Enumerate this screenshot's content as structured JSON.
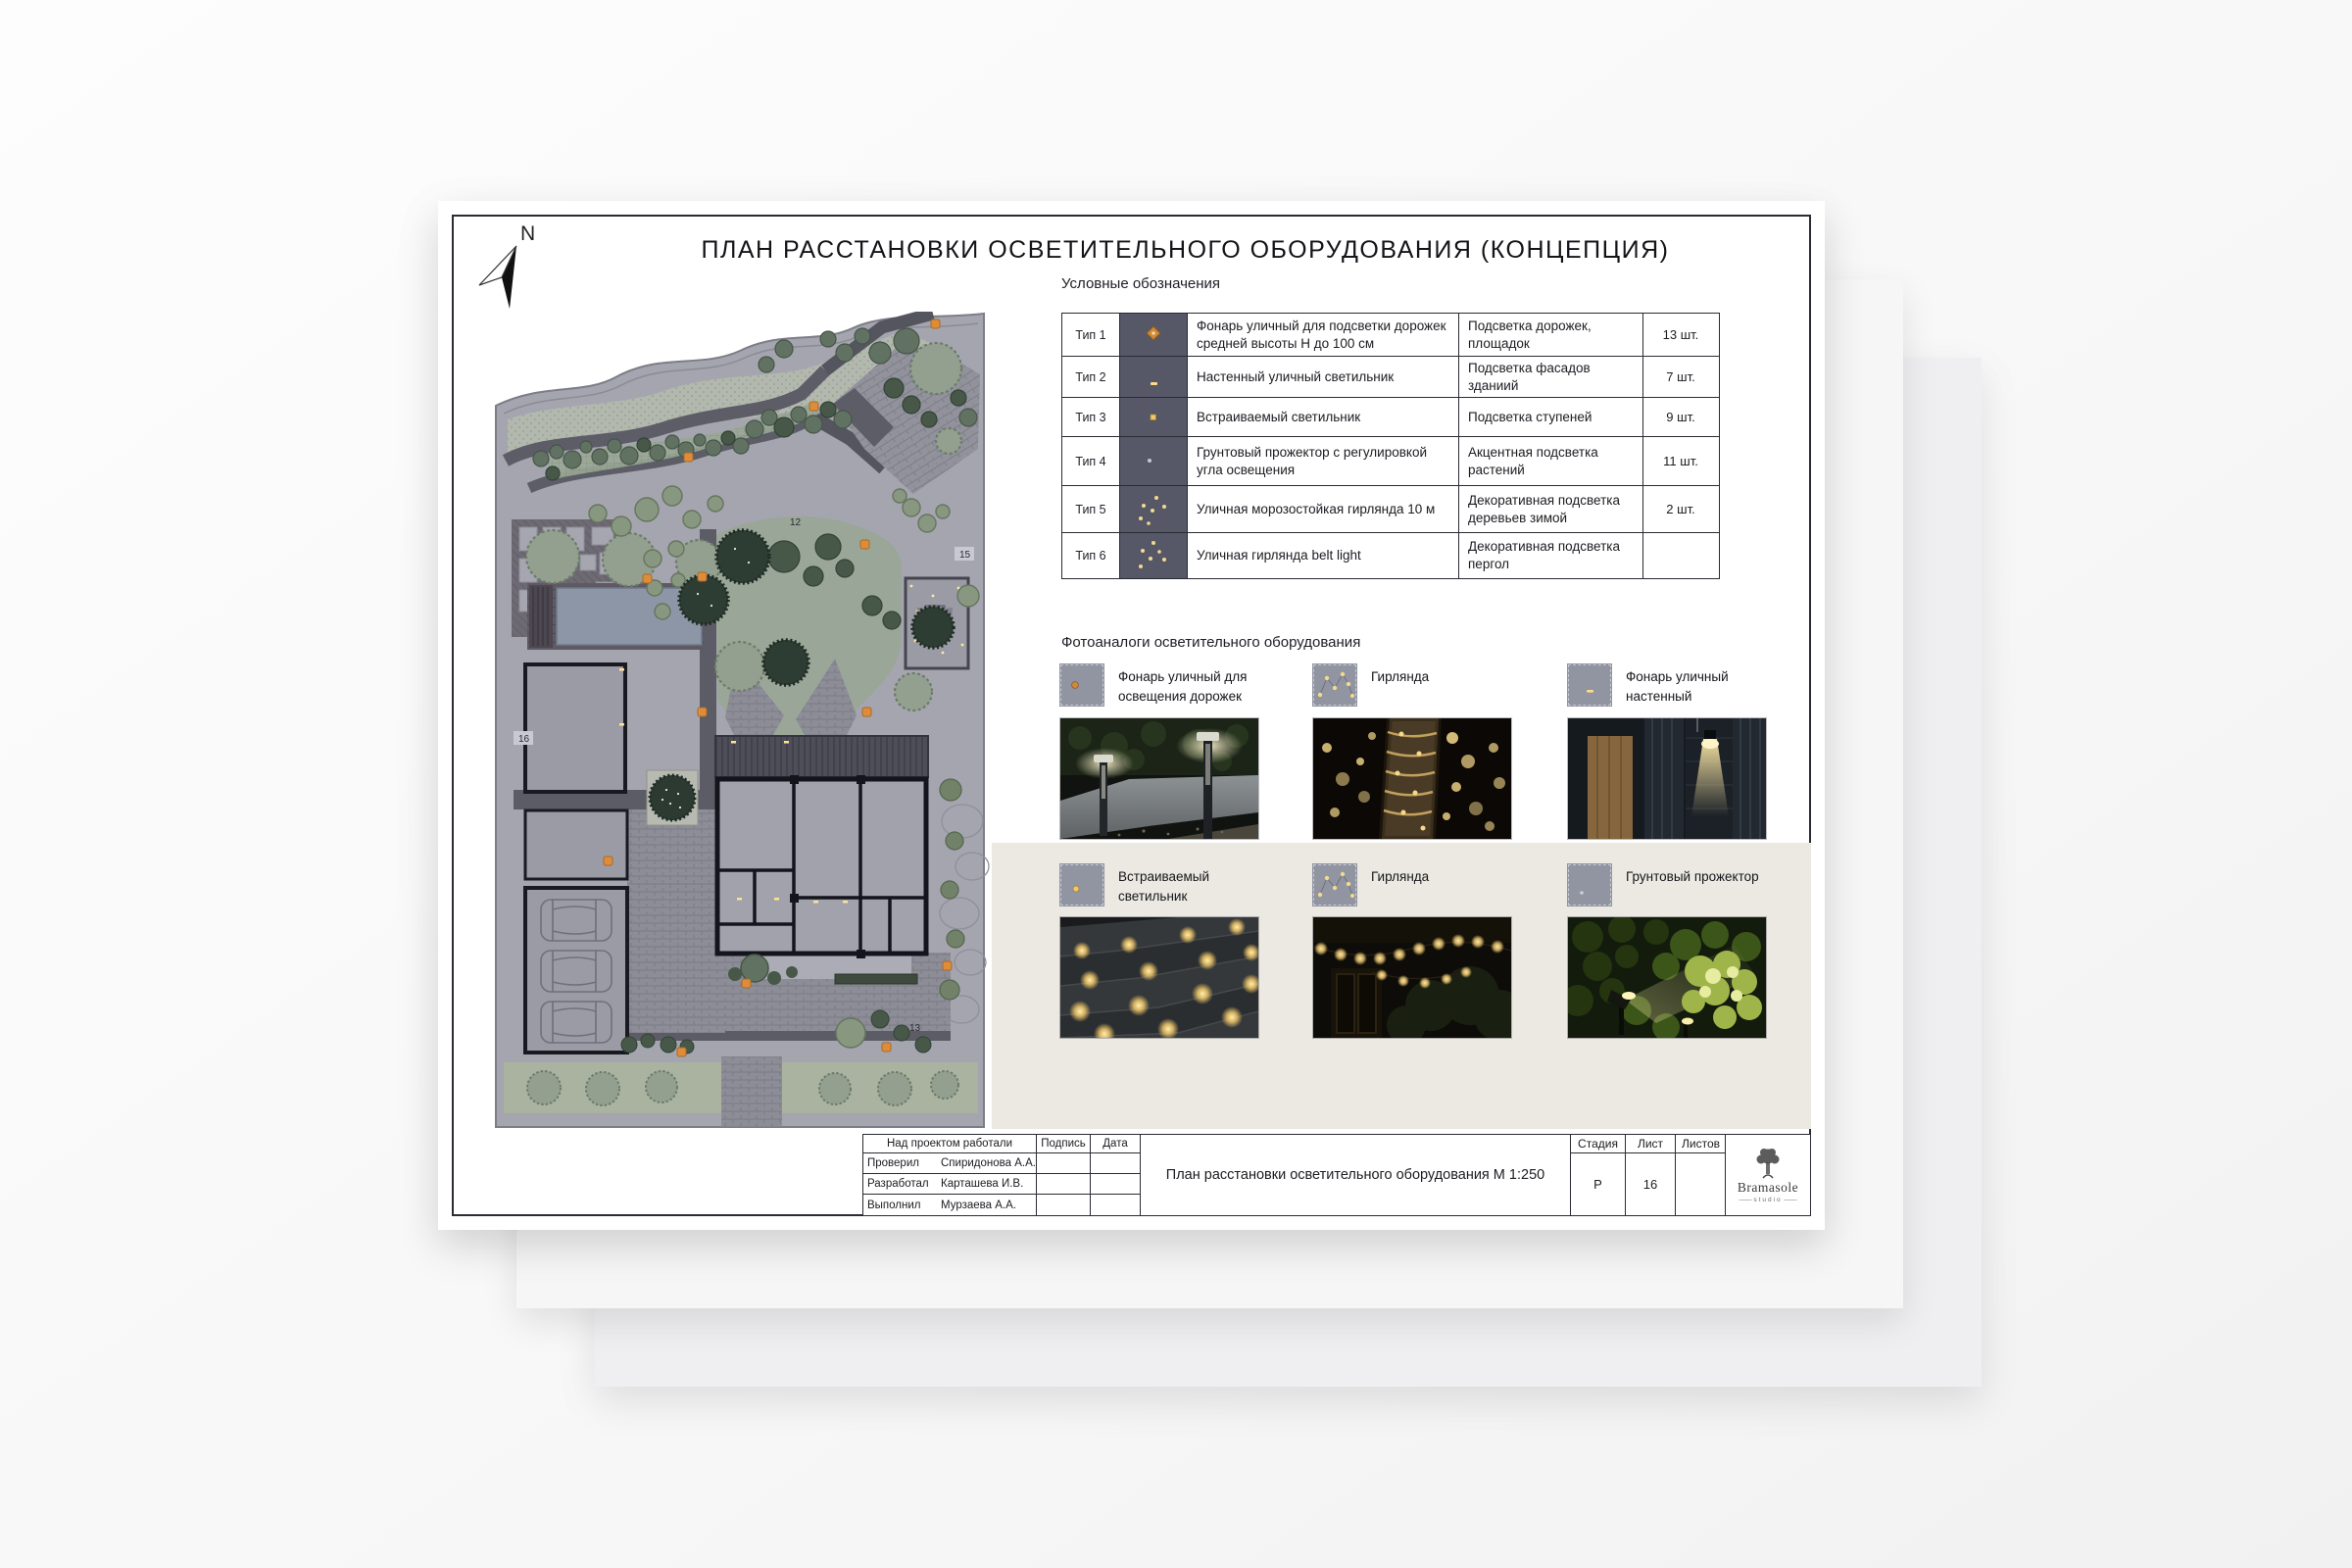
{
  "sheet": {
    "title": "ПЛАН РАССТАНОВКИ ОСВЕТИТЕЛЬНОГО ОБОРУДОВАНИЯ (КОНЦЕПЦИЯ)"
  },
  "north": {
    "label": "N"
  },
  "legend": {
    "title": "Условные обозначения",
    "rows": [
      {
        "type": "Тип 1",
        "icon": "bollard-light",
        "description": "Фонарь уличный для подсветки дорожек средней высоты Н до 100 см",
        "purpose": "Подсветка дорожек, площадок",
        "count": "13 шт."
      },
      {
        "type": "Тип 2",
        "icon": "wall-light",
        "description": "Настенный уличный светильник",
        "purpose": "Подсветка фасадов зданиий",
        "count": "7 шт."
      },
      {
        "type": "Тип 3",
        "icon": "recessed-light",
        "description": "Встраиваемый светильник",
        "purpose": "Подсветка ступеней",
        "count": "9 шт."
      },
      {
        "type": "Тип 4",
        "icon": "ground-spotlight",
        "description": "Грунтовый прожектор с регулировкой угла освещения",
        "purpose": "Акцентная подсветка растений",
        "count": "11 шт."
      },
      {
        "type": "Тип 5",
        "icon": "garland",
        "description": "Уличная морозостойкая гирлянда 10 м",
        "purpose": "Декоративная подсветка деревьев зимой",
        "count": "2 шт."
      },
      {
        "type": "Тип 6",
        "icon": "belt-light-garland",
        "description": "Уличная гирлянда belt light",
        "purpose": "Декоративная подсветка пергол",
        "count": ""
      }
    ]
  },
  "photos": {
    "title": "Фотоаналоги осветительного оборудования",
    "items": [
      {
        "label": "Фонарь уличный для освещения дорожек",
        "icon": "bollard-light"
      },
      {
        "label": "Гирлянда",
        "icon": "garland"
      },
      {
        "label": "Фонарь уличный настенный",
        "icon": "wall-light"
      },
      {
        "label": "Встраиваемый светильник",
        "icon": "recessed-light"
      },
      {
        "label": "Гирлянда",
        "icon": "garland"
      },
      {
        "label": "Грунтовый прожектор",
        "icon": "ground-spotlight"
      }
    ]
  },
  "titleblock": {
    "team_header": "Над проектом работали",
    "signature_header": "Подпись",
    "date_header": "Дата",
    "rows": [
      {
        "role": "Проверил",
        "name": "Спиридонова А.А."
      },
      {
        "role": "Разработал",
        "name": "Карташева И.В."
      },
      {
        "role": "Выполнил",
        "name": "Мурзаева А.А."
      }
    ],
    "drawing_title": "План расстановки осветительного оборудования М 1:250",
    "stage_label": "Стадия",
    "stage_value": "Р",
    "sheet_label": "Лист",
    "sheet_value": "16",
    "sheets_label": "Листов",
    "sheets_value": "",
    "logo_name": "Bramasole",
    "logo_sub": "studio"
  },
  "plan": {
    "labels": {
      "n12": "12",
      "n15": "15",
      "n16": "16",
      "n13": "13"
    }
  },
  "colors": {
    "accent_orange": "#dd8c3a",
    "legend_icon_bg": "#565868",
    "swatch_gray": "#9194a1",
    "band_beige": "#ebe9e1",
    "lawn_green": "#9aa697",
    "pool_blue": "#8c96a6"
  }
}
